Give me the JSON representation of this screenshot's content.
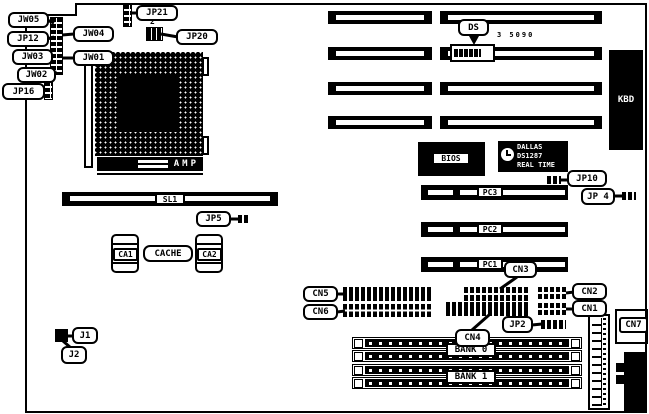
{
  "diagram_title": "motherboard-layout-diagram",
  "part_number": "3 5090",
  "colors": {
    "line": "#000000",
    "background": "#ffffff"
  },
  "labels": {
    "jw05": "JW05",
    "jw04": "JW04",
    "jp12": "JP12",
    "jw03": "JW03",
    "jw01": "JW01",
    "jw02": "JW02",
    "jp16": "JP16",
    "jp21": "JP21",
    "jp20": "JP20",
    "jp20_pin": "2",
    "ds": "DS",
    "kbd": "KBD",
    "amp": "AMP",
    "sl1": "SL1",
    "jp5": "JP5",
    "ca1": "CA1",
    "cache": "CACHE",
    "ca2": "CA2",
    "bios": "BIOS",
    "dallas_line1": "DALLAS",
    "dallas_line2": "DS1287",
    "dallas_line3": "REAL TIME",
    "jp10": "JP10",
    "jp4": "JP 4",
    "pc3": "PC3",
    "pc2": "PC2",
    "pc1": "PC1",
    "cn3": "CN3",
    "cn5": "CN5",
    "cn6": "CN6",
    "cn2": "CN2",
    "cn1": "CN1",
    "cn4": "CN4",
    "jp2": "JP2",
    "cn7": "CN7",
    "j1": "J1",
    "j2": "J2",
    "bank0": "BANK 0",
    "bank1": "BANK 1"
  }
}
